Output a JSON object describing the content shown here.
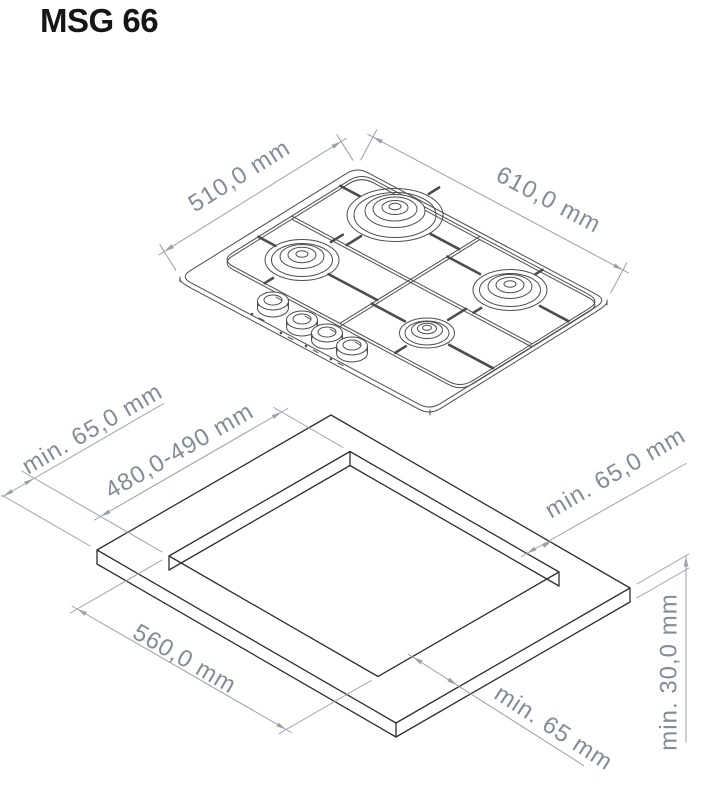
{
  "title": "MSG 66",
  "colors": {
    "hob_line": "#4d4d4d",
    "worktop_line": "#2e2e2e",
    "dimension_line": "#9aa1ab",
    "dimension_text": "#828c98",
    "title_text": "#161616"
  },
  "hob_drawing": {
    "depth_label": "510,0 mm",
    "width_label": "610,0 mm"
  },
  "installation_drawing": {
    "margin_left_label": "min. 65,0 mm",
    "cutout_depth_label": "480,0-490 mm",
    "margin_right_label": "min. 65,0 mm",
    "cutout_width_label": "560,0 mm",
    "margin_front_label": "min. 65 mm",
    "worktop_thickness_label": "min. 30,0 mm"
  }
}
